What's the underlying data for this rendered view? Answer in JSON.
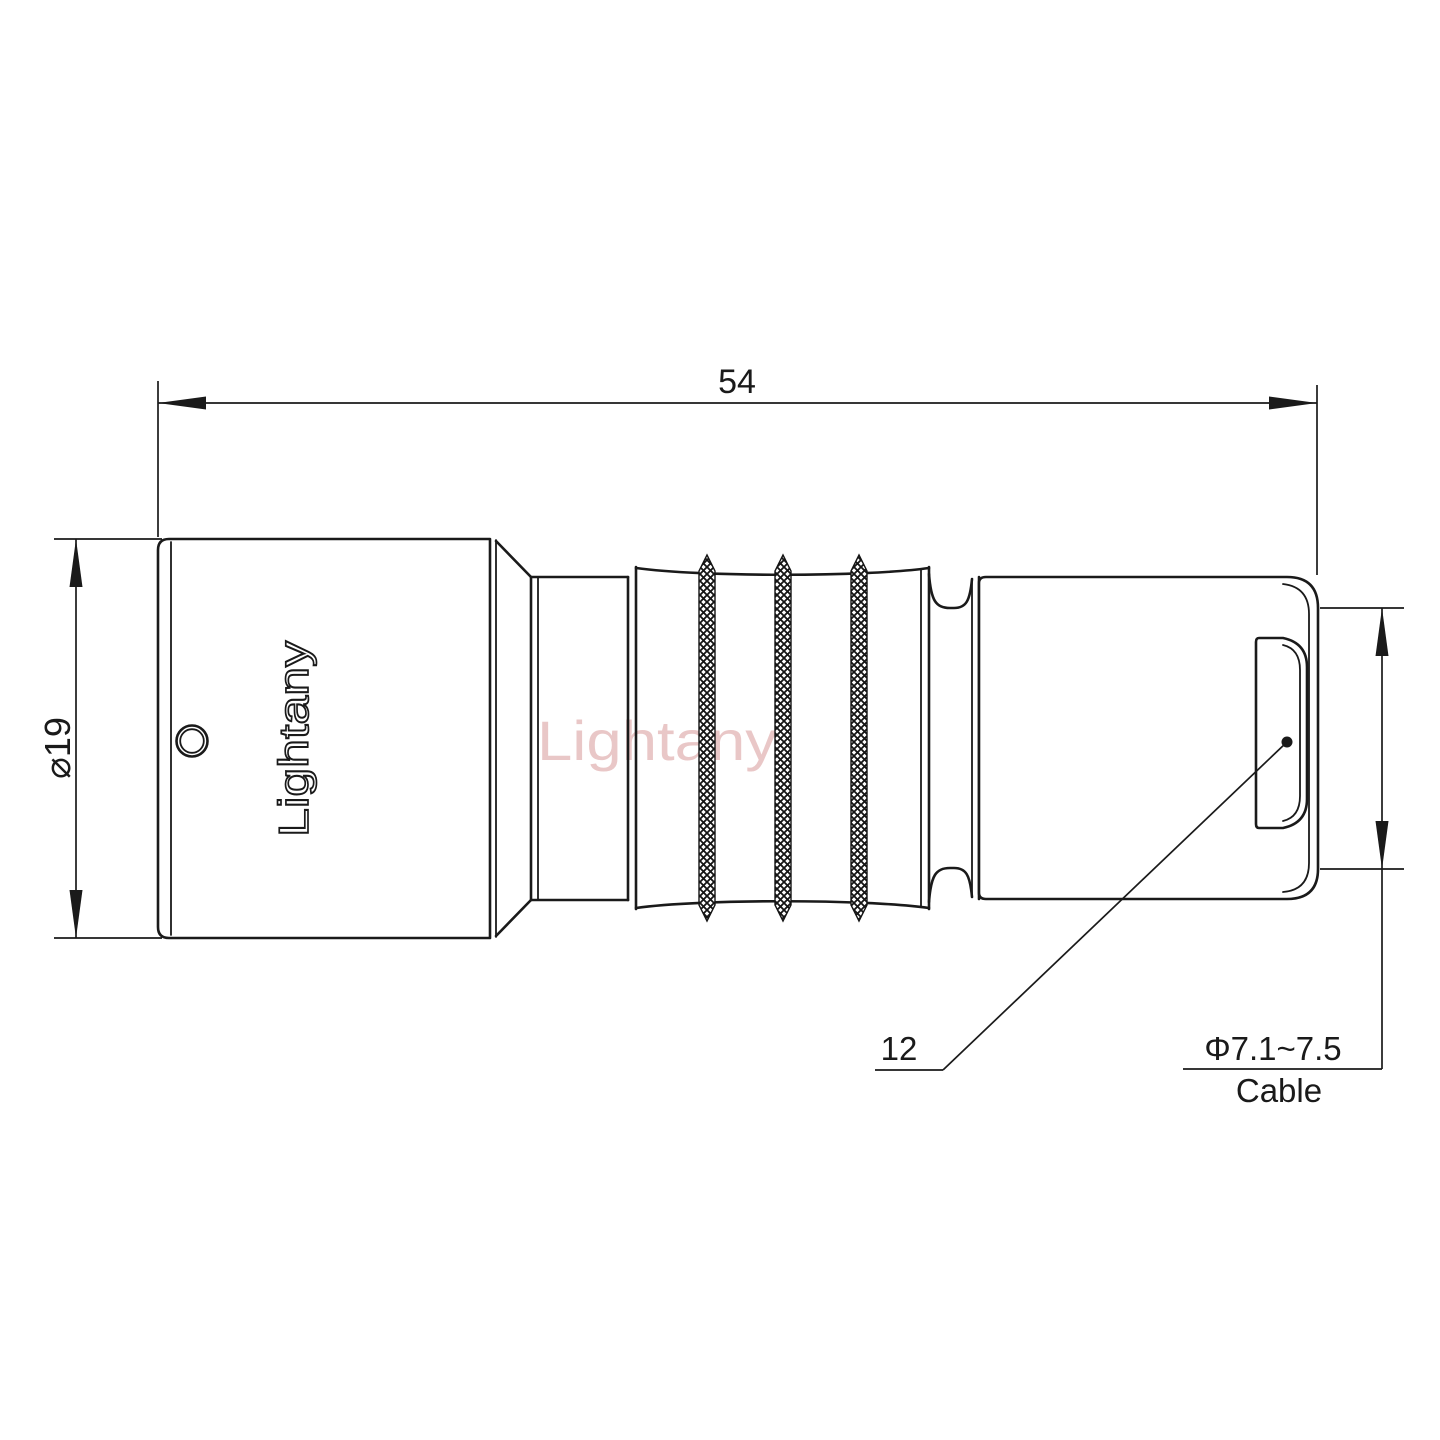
{
  "canvas": {
    "background": "#ffffff",
    "line_color": "#1a1a1a"
  },
  "watermark": {
    "text": "Lightany",
    "color": "#d89a9a"
  },
  "connector": {
    "engraving": "Lightany"
  },
  "dimensions": {
    "overall_length": "54",
    "front_diameter": "⌀19",
    "rear_size": "12",
    "cable_diameter": "Φ7.1~7.5",
    "cable_label": "Cable"
  }
}
